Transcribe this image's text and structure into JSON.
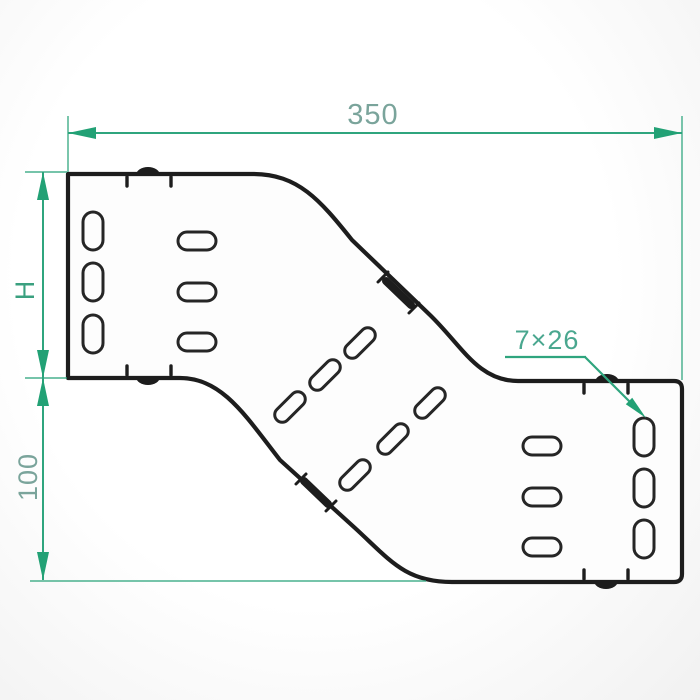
{
  "drawing": {
    "dimension_labels": {
      "overall_length": "350",
      "left_end_height": "H",
      "right_end_height": "100",
      "slot_size": "7×26"
    },
    "colors": {
      "dim_green": "#2fa57e",
      "dim_green_fill": "#22a175",
      "dim_text_soft": "#7aa49b",
      "dim_text_strong": "#3aa07f",
      "dim_text_mid": "#4aa78f",
      "outline_black": "#1d1d1d",
      "background": "#fafafa"
    }
  }
}
